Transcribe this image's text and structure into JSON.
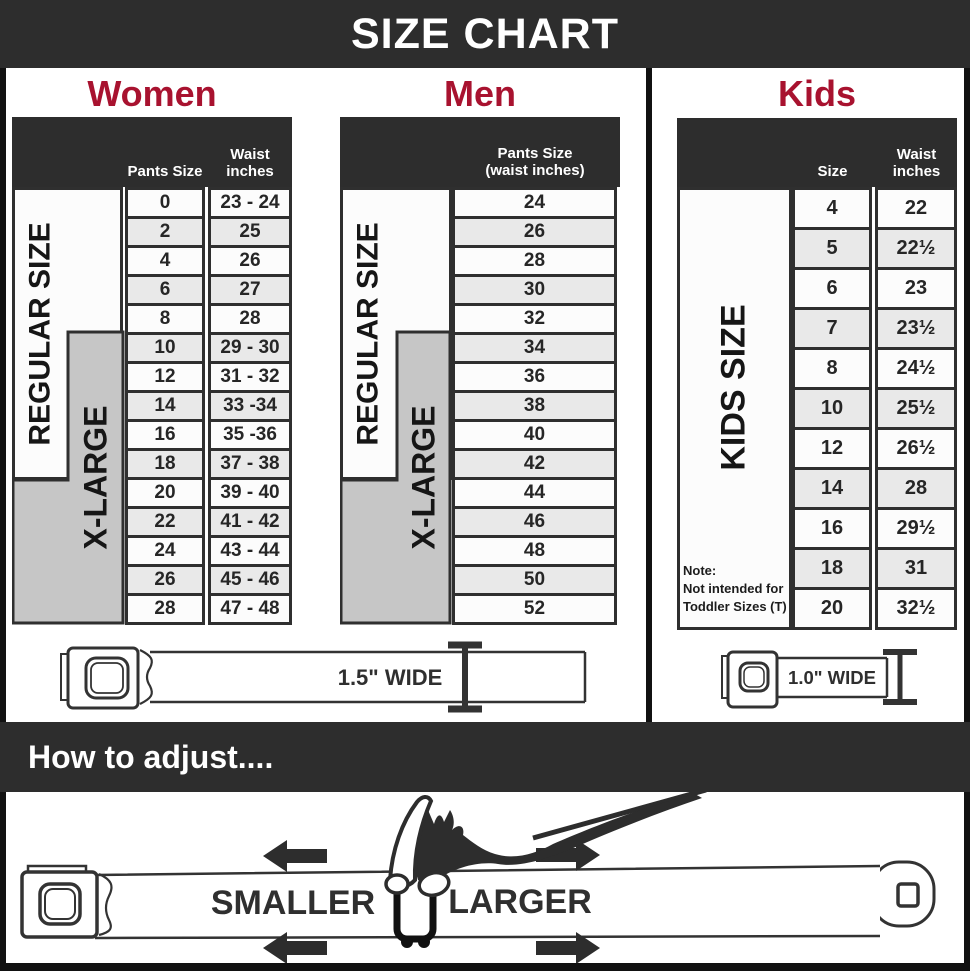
{
  "banner": {
    "title": "SIZE CHART"
  },
  "colors": {
    "dark_band": "#2d2d2d",
    "heading_red": "#a8122f",
    "xlarge_gray": "#c6c6c6",
    "row_alt": "#e9e9e9",
    "border": "#2f2f2f"
  },
  "women": {
    "heading": "Women",
    "col_pants": "Pants Size",
    "col_waist1": "Waist",
    "col_waist2": "inches",
    "regular_label": "REGULAR SIZE",
    "xlarge_label": "X-LARGE",
    "rows": [
      {
        "size": "0",
        "waist": "23 - 24"
      },
      {
        "size": "2",
        "waist": "25"
      },
      {
        "size": "4",
        "waist": "26"
      },
      {
        "size": "6",
        "waist": "27"
      },
      {
        "size": "8",
        "waist": "28"
      },
      {
        "size": "10",
        "waist": "29 - 30"
      },
      {
        "size": "12",
        "waist": "31 - 32"
      },
      {
        "size": "14",
        "waist": "33 -34"
      },
      {
        "size": "16",
        "waist": "35 -36"
      },
      {
        "size": "18",
        "waist": "37 - 38"
      },
      {
        "size": "20",
        "waist": "39 - 40"
      },
      {
        "size": "22",
        "waist": "41 - 42"
      },
      {
        "size": "24",
        "waist": "43 - 44"
      },
      {
        "size": "26",
        "waist": "45 - 46"
      },
      {
        "size": "28",
        "waist": "47 - 48"
      }
    ]
  },
  "men": {
    "heading": "Men",
    "col_header1": "Pants Size",
    "col_header2": "(waist inches)",
    "regular_label": "REGULAR SIZE",
    "xlarge_label": "X-LARGE",
    "rows": [
      "24",
      "26",
      "28",
      "30",
      "32",
      "34",
      "36",
      "38",
      "40",
      "42",
      "44",
      "46",
      "48",
      "50",
      "52"
    ]
  },
  "kids": {
    "heading": "Kids",
    "col_size": "Size",
    "col_waist1": "Waist",
    "col_waist2": "inches",
    "kids_label": "KIDS SIZE",
    "note1": "Note:",
    "note2": "Not intended for",
    "note3": "Toddler Sizes (T)",
    "rows": [
      {
        "size": "4",
        "waist": "22"
      },
      {
        "size": "5",
        "waist": "22½"
      },
      {
        "size": "6",
        "waist": "23"
      },
      {
        "size": "7",
        "waist": "23½"
      },
      {
        "size": "8",
        "waist": "24½"
      },
      {
        "size": "10",
        "waist": "25½"
      },
      {
        "size": "12",
        "waist": "26½"
      },
      {
        "size": "14",
        "waist": "28"
      },
      {
        "size": "16",
        "waist": "29½"
      },
      {
        "size": "18",
        "waist": "31"
      },
      {
        "size": "20",
        "waist": "32½"
      }
    ]
  },
  "belts": {
    "adult_label": "1.5\" WIDE",
    "kids_label": "1.0\" WIDE"
  },
  "adjust": {
    "heading": "How to adjust....",
    "smaller": "SMALLER",
    "larger": "LARGER"
  }
}
